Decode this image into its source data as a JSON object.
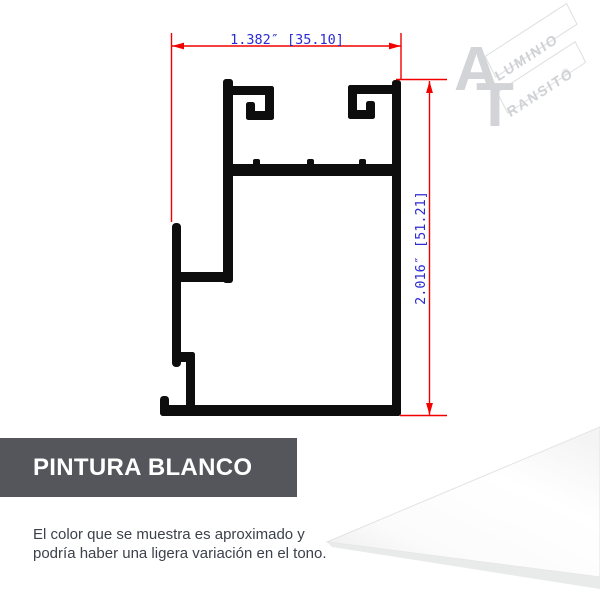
{
  "drawing": {
    "width_label": "1.382″ [35.10]",
    "height_label": "2.016″ [51.21]",
    "dimensions": {
      "width_inches": "1.382",
      "width_mm": "35.10",
      "height_inches": "2.016",
      "height_mm": "51.21"
    },
    "colors": {
      "profile": "#0d0d0d",
      "dimension_line": "#f20000",
      "dimension_text": "#2b2bd5"
    }
  },
  "watermark": {
    "letter_a": "A",
    "letter_t": "T",
    "word_top": "LUMINIO",
    "word_bottom": "RANSITO",
    "registered": "®",
    "color": "#d3d4d7"
  },
  "banner": {
    "label": "PINTURA BLANCO",
    "background": "#54565b",
    "text_color": "#ffffff"
  },
  "disclaimer": {
    "line1": "El color que se muestra es aproximado y",
    "line2": "podría haber una ligera variación en el tono."
  },
  "swatch": {
    "name": "white-paint-sample",
    "color": "#ffffff"
  }
}
